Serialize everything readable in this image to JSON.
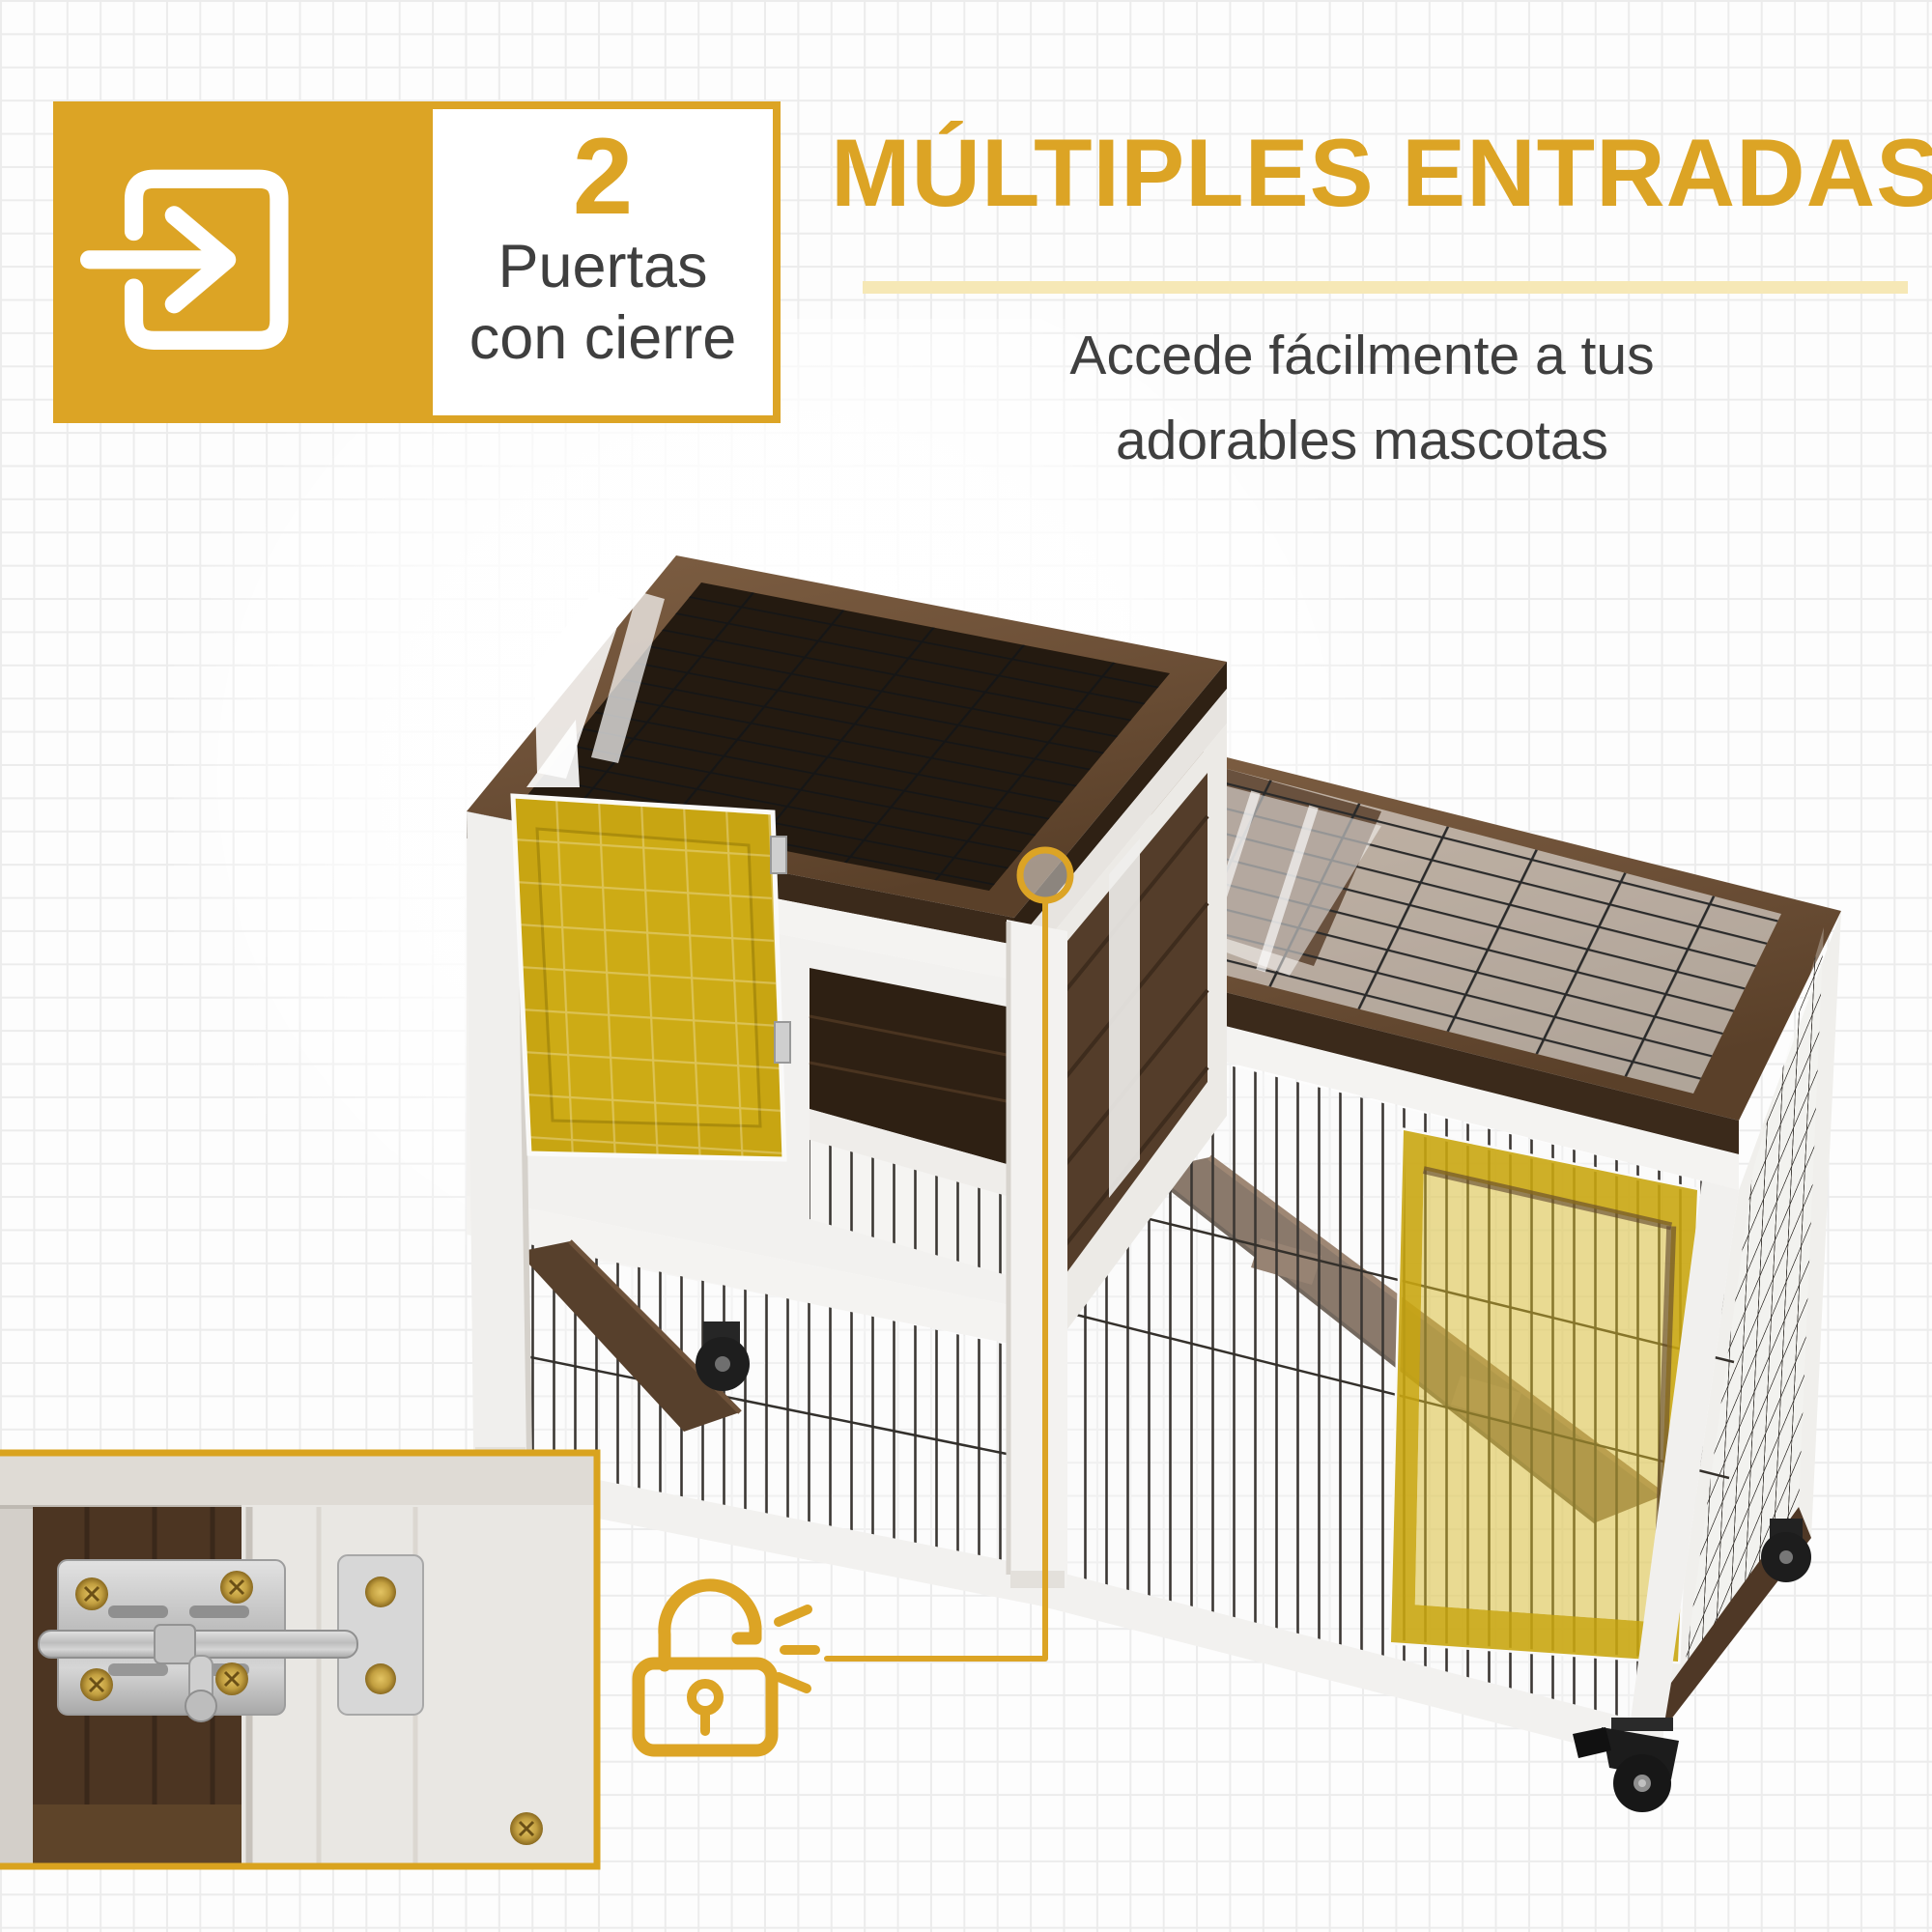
{
  "badge": {
    "value": "2",
    "line1": "Puertas",
    "line2": "con cierre"
  },
  "headline": {
    "title": "MÚLTIPLES ENTRADAS",
    "subtitle_line1": "Accede fácilmente a tus",
    "subtitle_line2": "adorables mascotas"
  },
  "icons": {
    "badge_icon": "door-exit-arrow-icon",
    "callout_icon": "open-padlock-icon",
    "callout_marks": "click-emphasis-marks",
    "callout_ring": "latch-highlight-ring"
  },
  "colors": {
    "accent_gold": "#DCA425",
    "divider_pale": "#F6E8B6",
    "door_highlight_yellow": "#C9A611",
    "wood_dark_brown": "#4C3522",
    "rim_wood_brown": "#6E5138",
    "frame_white": "#F2F1EF",
    "text_dark": "#3F3F3F",
    "grid_line": "#ECECEC"
  }
}
